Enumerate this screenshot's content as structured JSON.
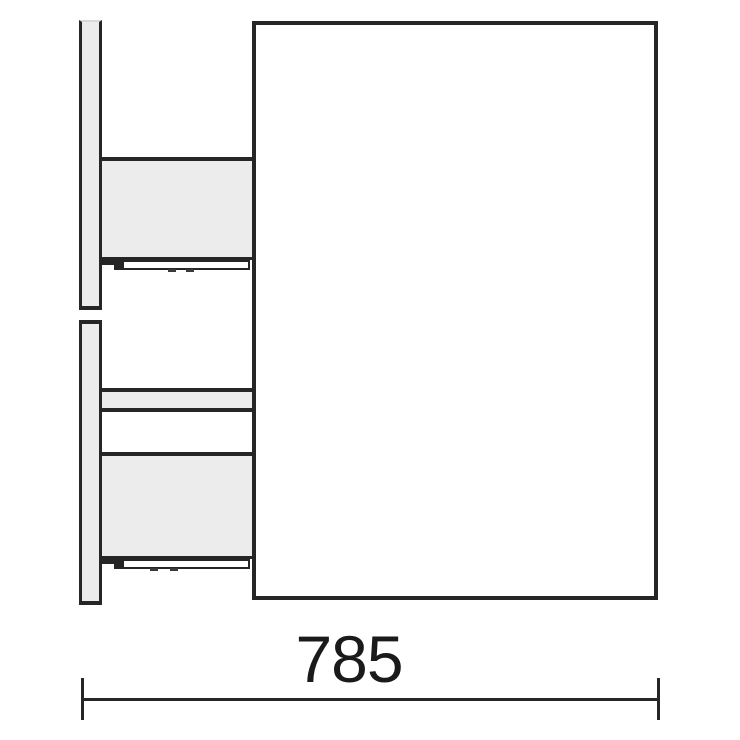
{
  "diagram": {
    "kind": "furniture-side-view-technical-drawing",
    "dimension": {
      "width_label": "785"
    },
    "colors": {
      "line": "#262626",
      "panel_fill": "#ececec",
      "background": "#ffffff",
      "text": "#1a1a1a"
    }
  }
}
